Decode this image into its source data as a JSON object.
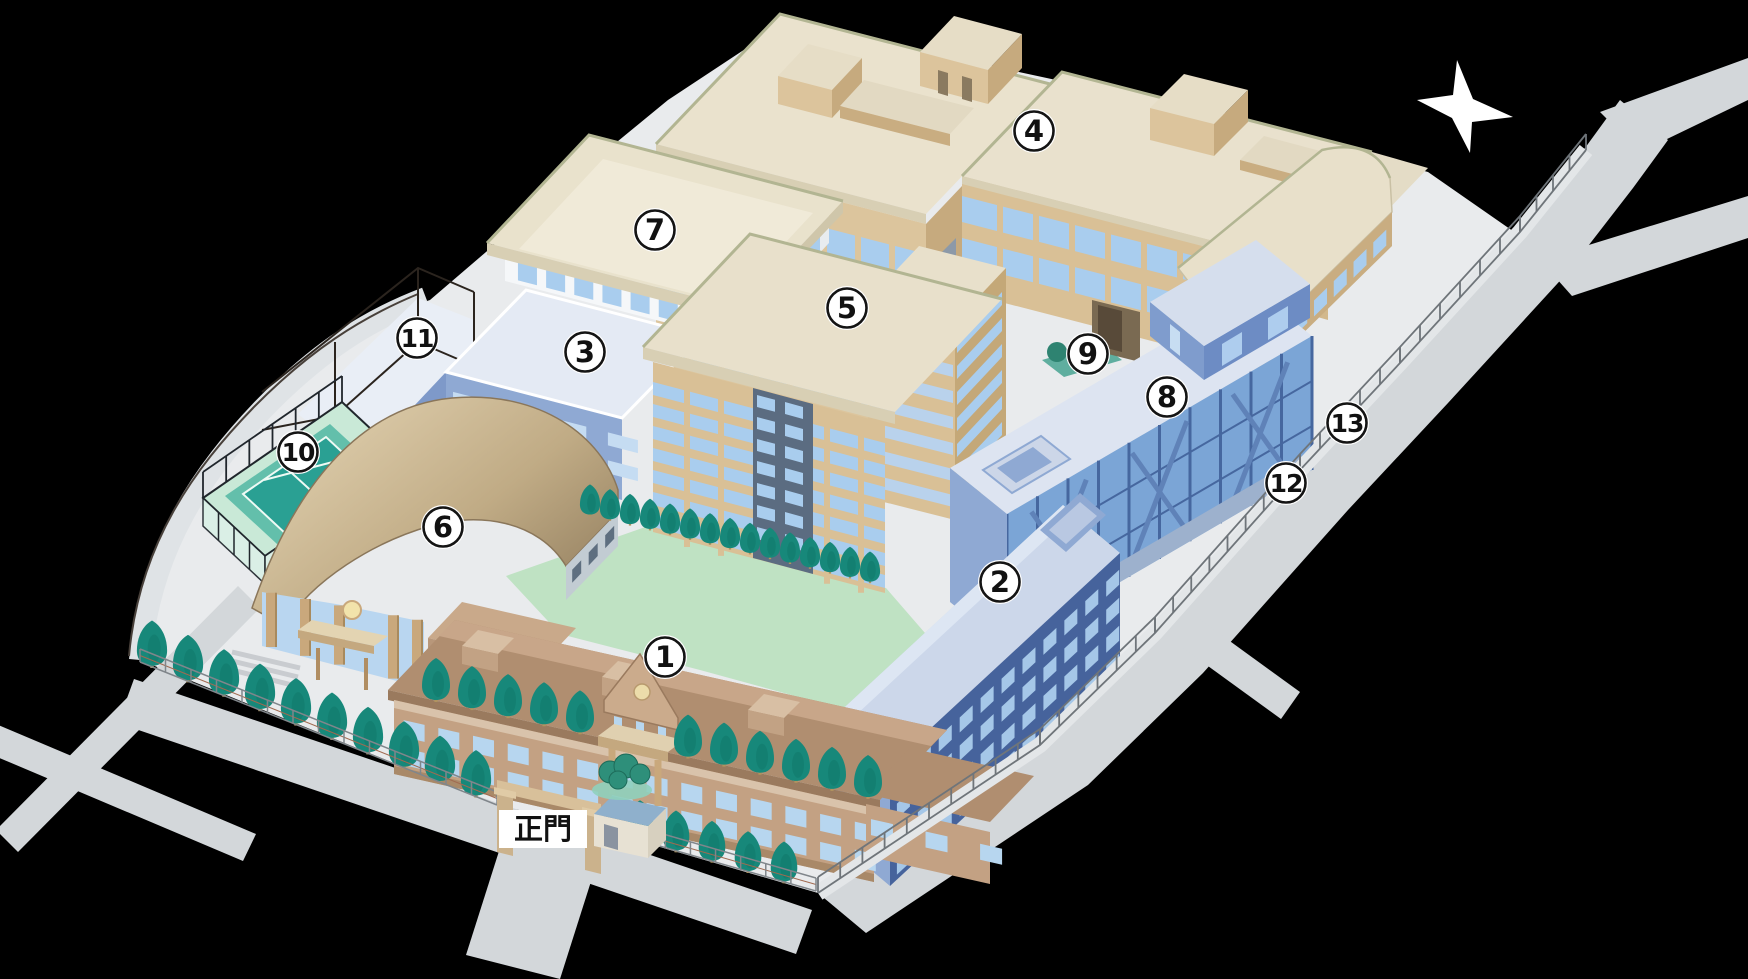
{
  "title": "campus-guide-map",
  "canvas": {
    "width": 1748,
    "height": 979,
    "background_color": "#000000"
  },
  "gate": {
    "label": "正門"
  },
  "compass": {
    "icon": "north-star-compass-icon",
    "color": "#ffffff"
  },
  "legend_markers": [
    {
      "label": "1",
      "x": 665,
      "y": 657
    },
    {
      "label": "2",
      "x": 1000,
      "y": 582
    },
    {
      "label": "3",
      "x": 585,
      "y": 352
    },
    {
      "label": "4",
      "x": 1034,
      "y": 131
    },
    {
      "label": "5",
      "x": 847,
      "y": 308
    },
    {
      "label": "6",
      "x": 443,
      "y": 527
    },
    {
      "label": "7",
      "x": 655,
      "y": 230
    },
    {
      "label": "8",
      "x": 1167,
      "y": 397
    },
    {
      "label": "9",
      "x": 1088,
      "y": 354
    },
    {
      "label": "10",
      "x": 298,
      "y": 452
    },
    {
      "label": "11",
      "x": 417,
      "y": 338
    },
    {
      "label": "12",
      "x": 1286,
      "y": 483
    },
    {
      "label": "13",
      "x": 1347,
      "y": 423
    }
  ],
  "marker_style": {
    "fill": "#ffffff",
    "ring": "#141414",
    "text": "#111111"
  },
  "palette": {
    "building_tan": "#d9c096",
    "building_tan_side": "#c4a878",
    "roof_cream": "#e8e0cb",
    "roof_trim_olive": "#b2b592",
    "building_blue": "#8fa9d3",
    "building_blue_dark": "#46639c",
    "glass_blue": "#7ba5d6",
    "window_blue": "#a9cdee",
    "roof_light_blue": "#dde4f1",
    "lawn_green": "#bfe2c3",
    "tree_green": "#17887a",
    "court_teal": "#2aa093",
    "ground_gray": "#e9ebed",
    "road_gray": "#d3d7da",
    "dome_tan": "#c3ae88",
    "historic_brown": "#c3a183",
    "historic_roof": "#b08e70"
  }
}
